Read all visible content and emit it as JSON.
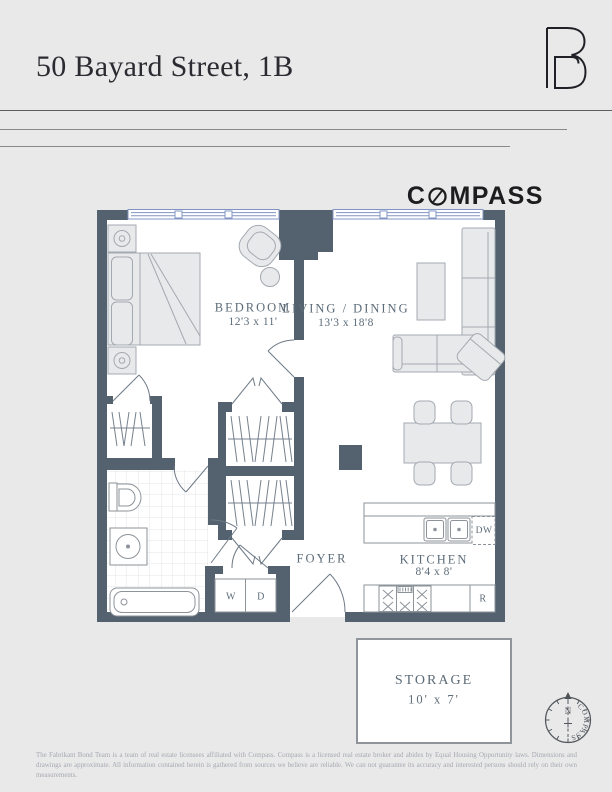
{
  "header": {
    "title": "50 Bayard Street, 1B",
    "brand": {
      "monogram": "FB",
      "wordmark_prefix": "C",
      "wordmark_suffix": "MPASS"
    }
  },
  "floorplan": {
    "wall_color": "#53626e",
    "rooms": [
      {
        "name": "BEDROOM",
        "dims": "12'3 x 11'"
      },
      {
        "name": "LIVING / DINING",
        "dims": "13'3 x 18'8"
      },
      {
        "name": "FOYER",
        "dims": ""
      },
      {
        "name": "KITCHEN",
        "dims": "8'4 x 8'"
      },
      {
        "name": "STORAGE",
        "dims": "10' x 7'"
      }
    ],
    "labels": {
      "washer": "W",
      "dryer": "D",
      "dishwasher": "DW",
      "refrigerator": "R"
    }
  },
  "compass_rose": {
    "north": "N",
    "text": "COMPASS"
  },
  "footer": {
    "disclaimer": "The Fabrikant Bond Team is a team of real estate licensees affiliated with Compass. Compass is a licensed real estate broker and abides by Equal Housing Opportunity laws. Dimensions and drawings are approximate. All information contained herein is gathered from sources we believe are reliable. We can not guarantee its accuracy and interested persons should rely on their own measurements."
  }
}
